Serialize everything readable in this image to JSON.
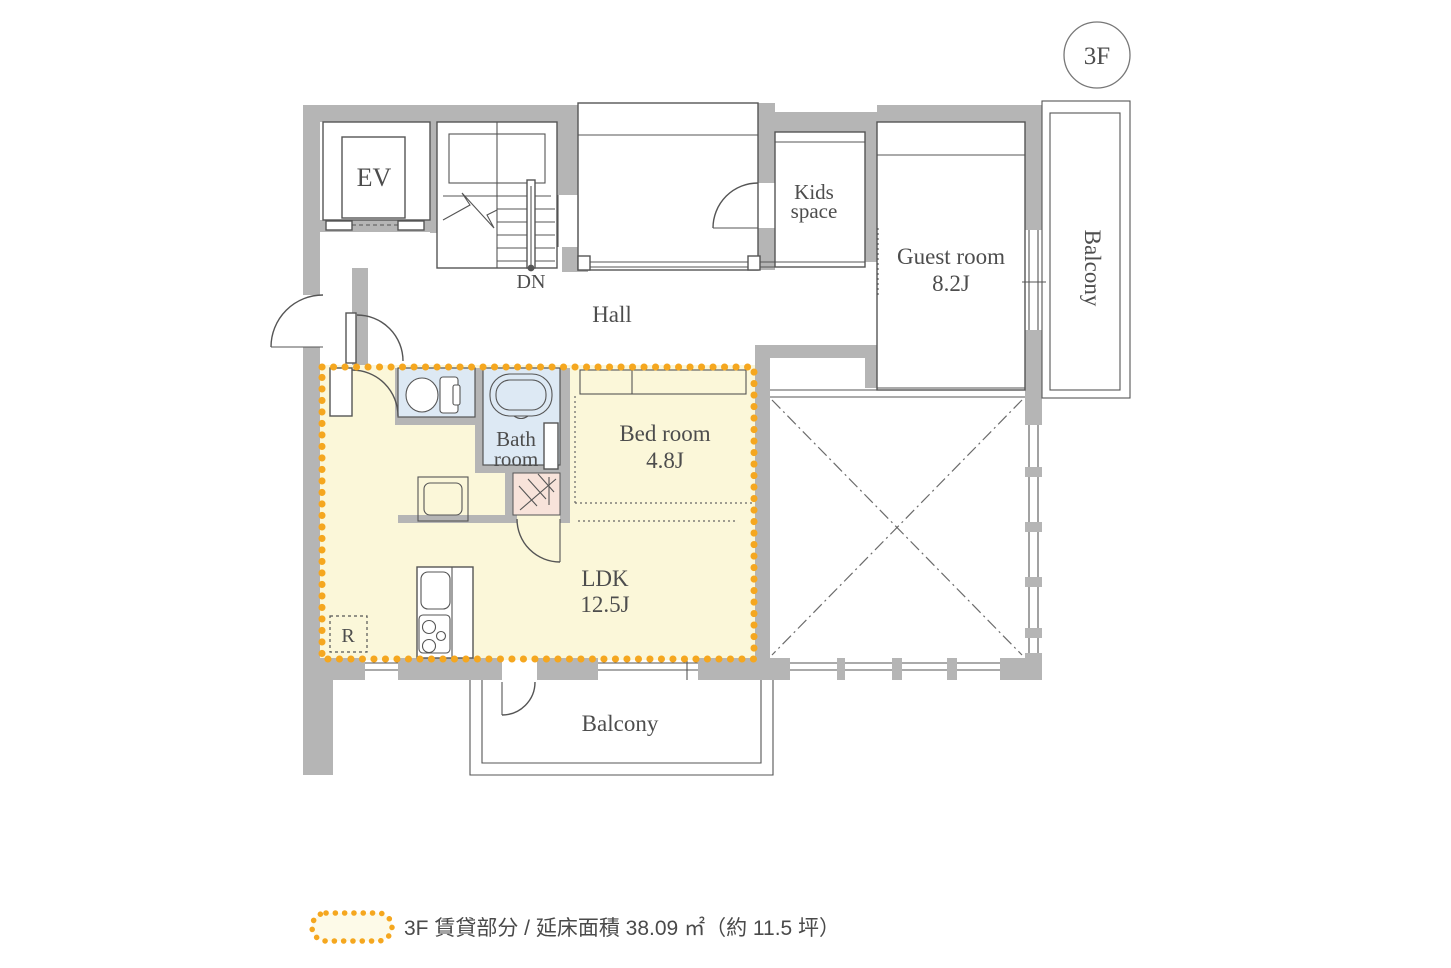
{
  "floor_badge": {
    "label": "3F"
  },
  "rooms": {
    "ev": "EV",
    "dn": "DN",
    "hall": "Hall",
    "kids_line1": "Kids",
    "kids_line2": "space",
    "guest_name": "Guest room",
    "guest_size": "8.2J",
    "balcony_right": "Balcony",
    "balcony_bottom": "Balcony",
    "bath_line1": "Bath",
    "bath_line2": "room",
    "bed_name": "Bed room",
    "bed_size": "4.8J",
    "ldk_name": "LDK",
    "ldk_size": "12.5J",
    "fridge": "R"
  },
  "legend": {
    "label": "3F 賃貸部分 / 延床面積 38.09 ㎡（約 11.5 坪）"
  },
  "colors": {
    "wall": "#b5b5b5",
    "line": "#555555",
    "text": "#4d4d4d",
    "rental_fill": "#fbf7d9",
    "wet_room_fill": "#dde9f4",
    "utility_fill": "#f8e3da",
    "rental_border": "#f5a71f",
    "legend_pill_fill": "#fdfae8"
  }
}
